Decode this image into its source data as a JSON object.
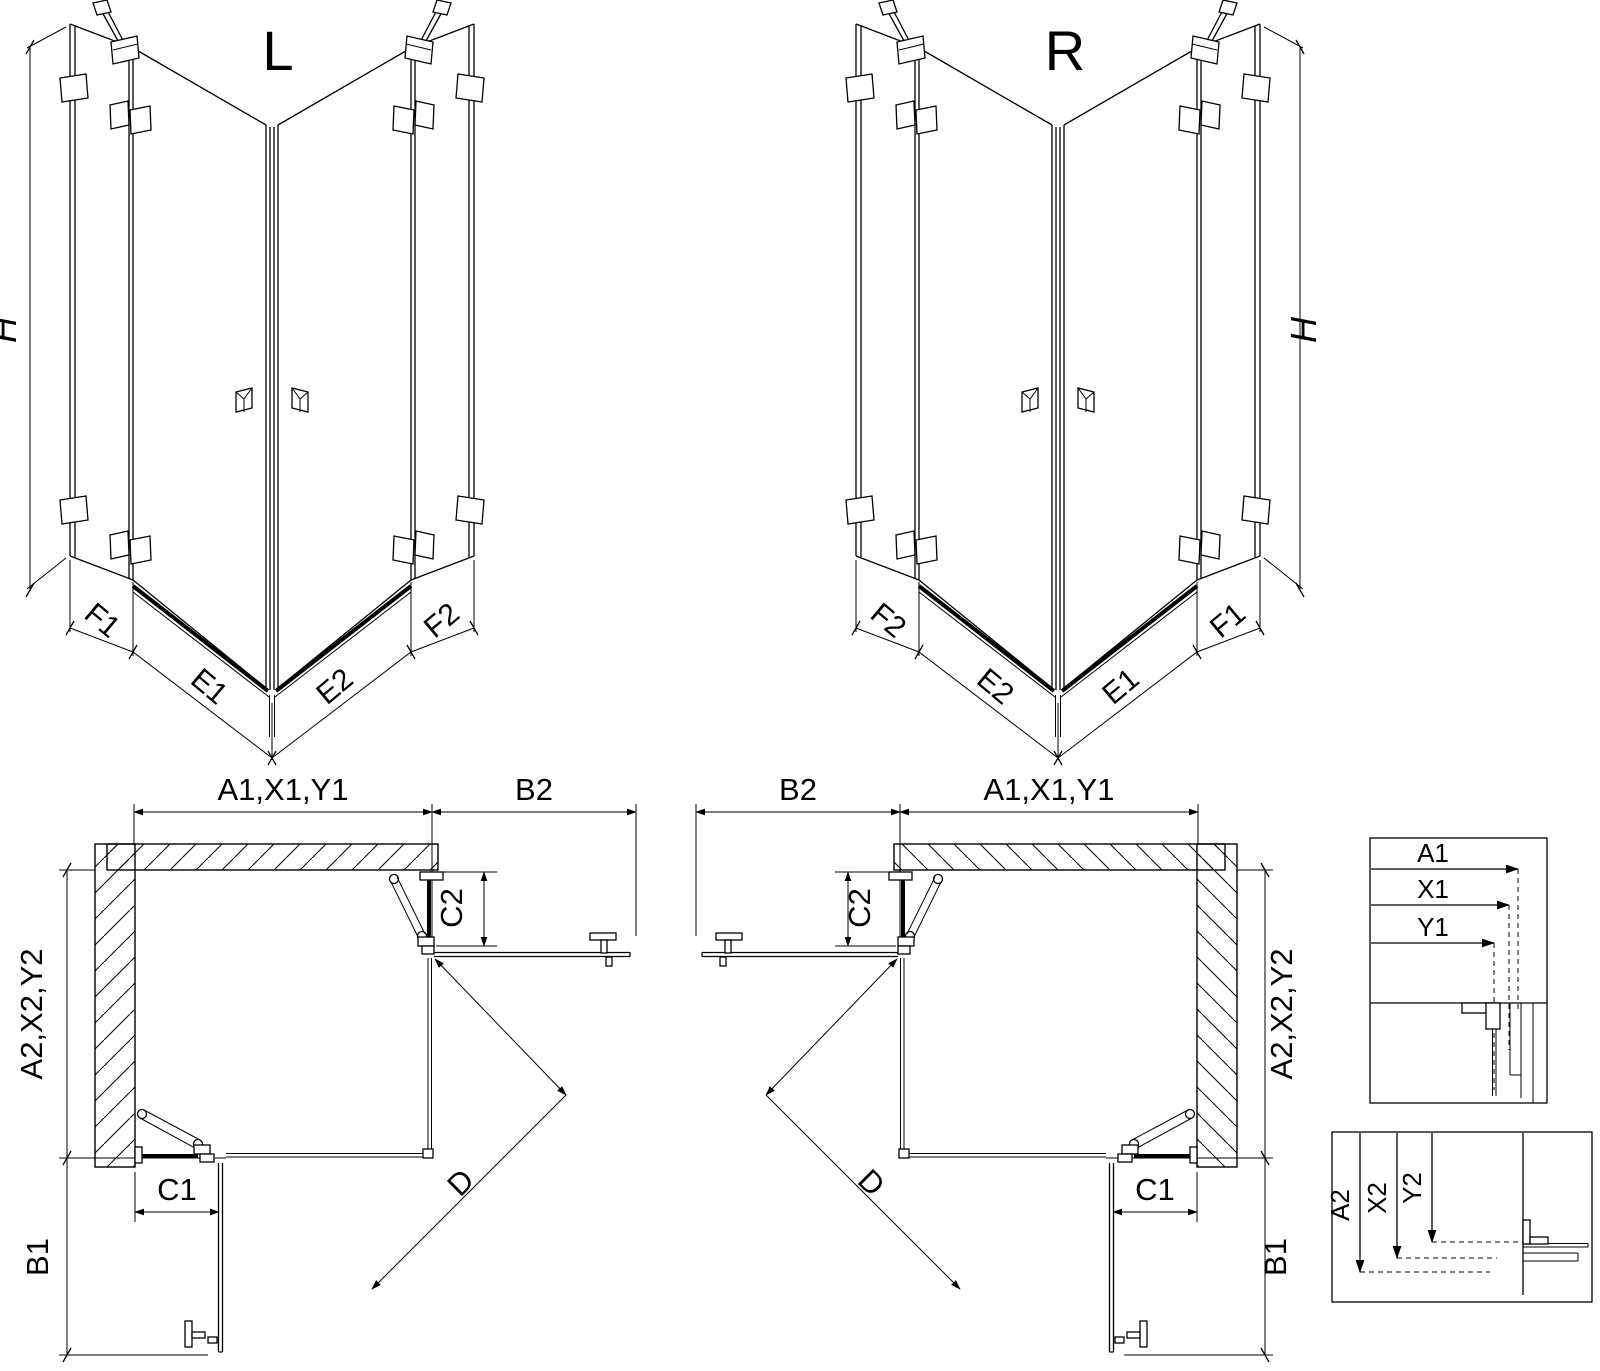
{
  "colors": {
    "line": "#000000",
    "background": "#ffffff"
  },
  "iso_left": {
    "title": "L",
    "height_label": "H",
    "dims": [
      "F1",
      "E1",
      "E2",
      "F2"
    ]
  },
  "iso_right": {
    "title": "R",
    "height_label": "H",
    "dims": [
      "F2",
      "E2",
      "E1",
      "F1"
    ]
  },
  "plan_left": {
    "width_label": "A1,X1,Y1",
    "door_width_label": "B2",
    "depth_label": "A2,X2,Y2",
    "door_depth_label": "B1",
    "fixed_bottom_label": "C1",
    "fixed_side_label": "C2",
    "diagonal_label": "D"
  },
  "plan_right": {
    "width_label": "A1,X1,Y1",
    "door_width_label": "B2",
    "depth_label": "A2,X2,Y2",
    "door_depth_label": "B1",
    "fixed_bottom_label": "C1",
    "fixed_side_label": "C2",
    "diagonal_label": "D"
  },
  "detail_widths": {
    "labels": [
      "A1",
      "X1",
      "Y1"
    ]
  },
  "detail_depths": {
    "labels": [
      "A2",
      "X2",
      "Y2"
    ]
  }
}
